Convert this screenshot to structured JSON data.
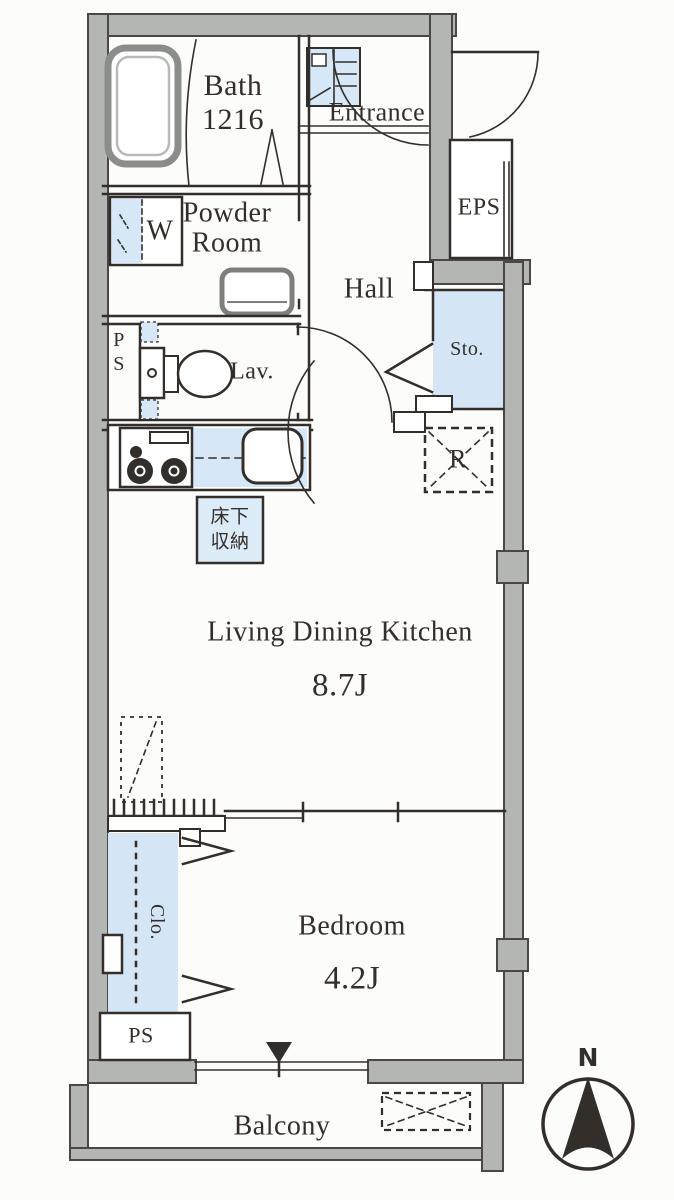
{
  "title": "1LDK apartment floor plan",
  "colors": {
    "wall_fill": "#b4b6b4",
    "wall_stroke": "#4b4744",
    "line": "#332e2a",
    "fixture_blue": "#d6e8f7",
    "floor_blue": "#d4e6f5",
    "text": "#332e2a"
  },
  "labels": {
    "bath_name": "Bath",
    "bath_size": "1216",
    "entrance": "Entrance",
    "powder_line1": "Powder",
    "powder_line2": "Room",
    "eps": "EPS",
    "hall": "Hall",
    "ps_upper_line1": "P",
    "ps_upper_line2": "S",
    "lav": "Lav.",
    "sto": "Sto.",
    "washer": "W",
    "fridge": "R",
    "underfloor_line1": "床下",
    "underfloor_line2": "収納",
    "ldk": "Living Dining Kitchen",
    "ldk_size": "8.7J",
    "clo": "Clo.",
    "bedroom": "Bedroom",
    "bedroom_size": "4.2J",
    "ps_lower": "PS",
    "balcony": "Balcony",
    "compass_n": "N"
  }
}
